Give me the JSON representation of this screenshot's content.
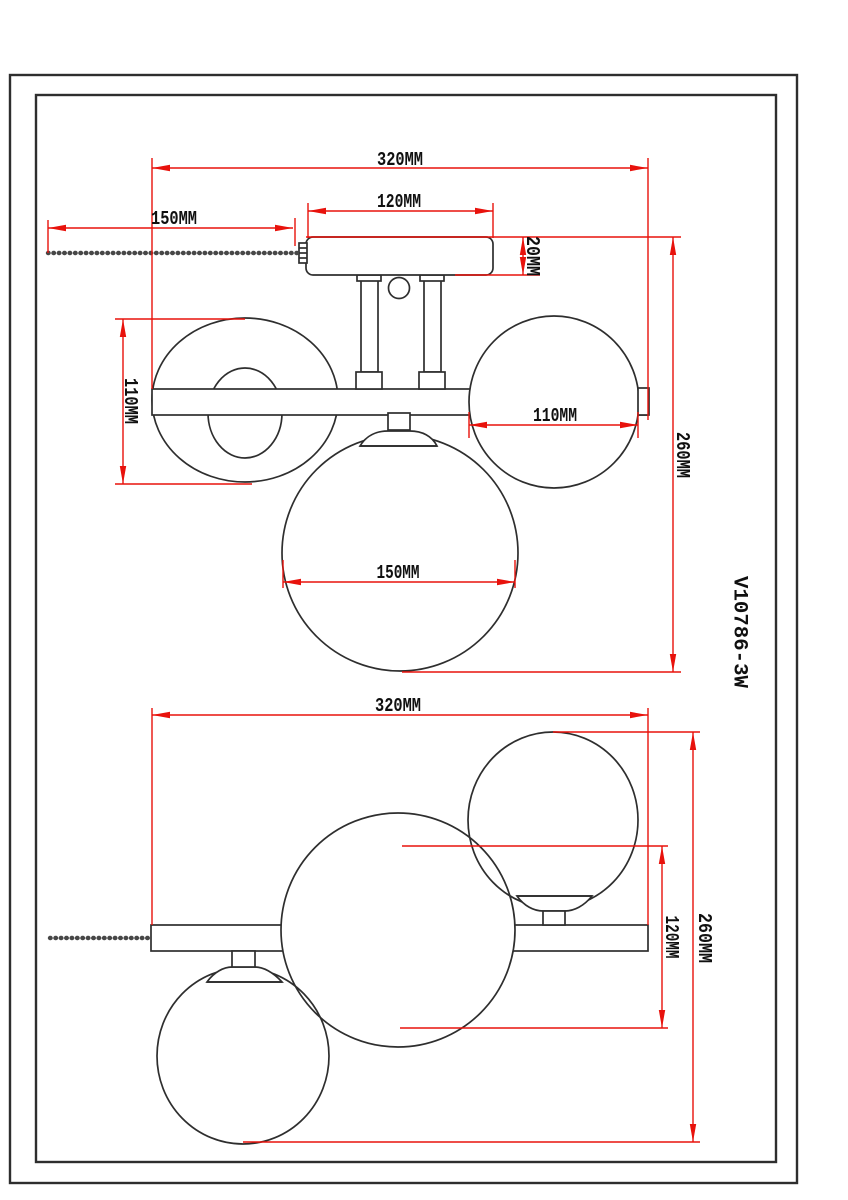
{
  "model_number": "V10786-3W",
  "colors": {
    "background": "#ffffff",
    "line": "#2e2e2e",
    "dimension": "#e8120c",
    "text": "#101010"
  },
  "front_view": {
    "overall_width": "320MM",
    "canopy_width": "120MM",
    "pull_chain_length": "150MM",
    "canopy_height": "20MM",
    "side_globe_height": "110MM",
    "side_globe_diameter": "110MM",
    "center_globe_diameter": "150MM",
    "overall_height": "260MM"
  },
  "top_view": {
    "overall_width": "320MM",
    "globe_span": "120MM",
    "overall_depth": "260MM"
  }
}
